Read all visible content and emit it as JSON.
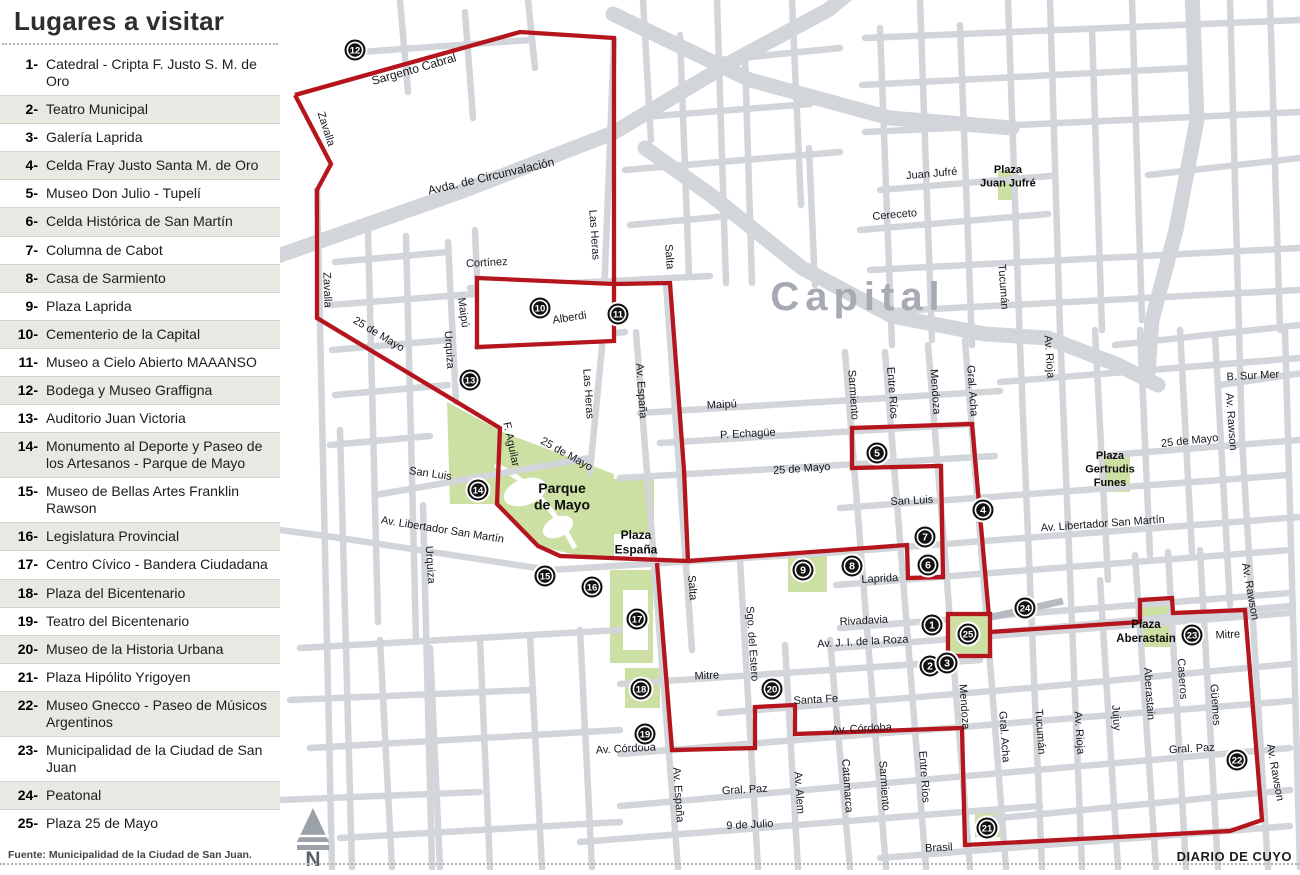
{
  "panel": {
    "title": "Lugares a visitar",
    "source": "Fuente: Municipalidad de la Ciudad de San Juan.",
    "items": [
      {
        "num": "1-",
        "label": "Catedral - Cripta F. Justo S. M. de Oro"
      },
      {
        "num": "2-",
        "label": "Teatro Municipal"
      },
      {
        "num": "3-",
        "label": "Galería Laprida"
      },
      {
        "num": "4-",
        "label": "Celda Fray Justo Santa M. de Oro"
      },
      {
        "num": "5-",
        "label": "Museo Don Julio - Tupelí"
      },
      {
        "num": "6-",
        "label": "Celda Histórica de San Martín"
      },
      {
        "num": "7-",
        "label": "Columna de Cabot"
      },
      {
        "num": "8-",
        "label": "Casa de Sarmiento"
      },
      {
        "num": "9-",
        "label": "Plaza Laprida"
      },
      {
        "num": "10-",
        "label": "Cementerio de la Capital"
      },
      {
        "num": "11-",
        "label": "Museo a Cielo Abierto MAAANSO"
      },
      {
        "num": "12-",
        "label": "Bodega y Museo Graffigna"
      },
      {
        "num": "13-",
        "label": "Auditorio Juan Victoria"
      },
      {
        "num": "14-",
        "label": "Monumento al Deporte y Paseo de los Artesanos - Parque de Mayo"
      },
      {
        "num": "15-",
        "label": "Museo de Bellas Artes Franklin Rawson"
      },
      {
        "num": "16-",
        "label": "Legislatura Provincial"
      },
      {
        "num": "17-",
        "label": "Centro Cívico - Bandera Ciudadana"
      },
      {
        "num": "18-",
        "label": "Plaza del Bicentenario"
      },
      {
        "num": "19-",
        "label": "Teatro del Bicentenario"
      },
      {
        "num": "20-",
        "label": "Museo de la Historia Urbana"
      },
      {
        "num": "21-",
        "label": "Plaza Hipólito Yrigoyen"
      },
      {
        "num": "22-",
        "label": "Museo Gnecco - Paseo de Músicos Argentinos"
      },
      {
        "num": "23-",
        "label": "Municipalidad de la Ciudad de San Juan"
      },
      {
        "num": "24-",
        "label": "Peatonal"
      },
      {
        "num": "25-",
        "label": "Plaza 25 de Mayo"
      }
    ]
  },
  "map": {
    "region_label": "Capital",
    "credit": "DIARIO DE CUYO",
    "north_label": "N",
    "colors": {
      "street": "#d2d5da",
      "route": "#b5151d",
      "green": "#cde0a4",
      "peatonal": "#b6bac1",
      "capital": "#a6abb3"
    },
    "street_labels": [
      {
        "t": "Sargento Cabral",
        "x": 135,
        "y": 73,
        "r": -16,
        "s": 12
      },
      {
        "t": "Zavalla",
        "x": 43,
        "y": 130,
        "r": 72
      },
      {
        "t": "Zavalla",
        "x": 44,
        "y": 290,
        "r": 88
      },
      {
        "t": "Avda. de Circunvalación",
        "x": 212,
        "y": 180,
        "r": -13,
        "s": 12
      },
      {
        "t": "Cortínez",
        "x": 207,
        "y": 266,
        "r": -3
      },
      {
        "t": "Maipú",
        "x": 180,
        "y": 313,
        "r": 82
      },
      {
        "t": "Alberdi",
        "x": 290,
        "y": 321,
        "r": -9
      },
      {
        "t": "Las Heras",
        "x": 311,
        "y": 235,
        "r": 86
      },
      {
        "t": "Las Heras",
        "x": 305,
        "y": 394,
        "r": 86
      },
      {
        "t": "Salta",
        "x": 386,
        "y": 257,
        "r": 86
      },
      {
        "t": "Salta",
        "x": 409,
        "y": 588,
        "r": 86
      },
      {
        "t": "Av. España",
        "x": 358,
        "y": 391,
        "r": 86
      },
      {
        "t": "Av. España",
        "x": 395,
        "y": 795,
        "r": 86
      },
      {
        "t": "25 de Mayo",
        "x": 97,
        "y": 337,
        "r": 31
      },
      {
        "t": "25 de Mayo",
        "x": 285,
        "y": 457,
        "r": 29
      },
      {
        "t": "25 de Mayo",
        "x": 522,
        "y": 472,
        "r": -4
      },
      {
        "t": "25 de Mayo",
        "x": 910,
        "y": 444,
        "r": -6
      },
      {
        "t": "P. Echagüe",
        "x": 468,
        "y": 437,
        "r": -3
      },
      {
        "t": "Maipú",
        "x": 442,
        "y": 408,
        "r": -3
      },
      {
        "t": "Urquiza",
        "x": 166,
        "y": 350,
        "r": 86
      },
      {
        "t": "Urquiza",
        "x": 147,
        "y": 565,
        "r": 86
      },
      {
        "t": "F. Aguilar",
        "x": 228,
        "y": 445,
        "r": 78
      },
      {
        "t": "San Luis",
        "x": 150,
        "y": 477,
        "r": 8
      },
      {
        "t": "San Luis",
        "x": 632,
        "y": 504,
        "r": -3
      },
      {
        "t": "Av. Libertador San Martín",
        "x": 162,
        "y": 533,
        "r": 9
      },
      {
        "t": "Av. Libertador San Martín",
        "x": 823,
        "y": 527,
        "r": -4
      },
      {
        "t": "Sarmiento",
        "x": 570,
        "y": 395,
        "r": 86
      },
      {
        "t": "Sarmiento",
        "x": 601,
        "y": 786,
        "r": 86
      },
      {
        "t": "Entre Ríos",
        "x": 609,
        "y": 393,
        "r": 86
      },
      {
        "t": "Entre Ríos",
        "x": 641,
        "y": 777,
        "r": 86
      },
      {
        "t": "Mendoza",
        "x": 652,
        "y": 392,
        "r": 86
      },
      {
        "t": "Mendoza",
        "x": 681,
        "y": 707,
        "r": 86
      },
      {
        "t": "Gral. Acha",
        "x": 689,
        "y": 391,
        "r": 86
      },
      {
        "t": "Gral. Acha",
        "x": 721,
        "y": 737,
        "r": 86
      },
      {
        "t": "Tucumán",
        "x": 720,
        "y": 287,
        "r": 86
      },
      {
        "t": "Tucumán",
        "x": 757,
        "y": 732,
        "r": 86
      },
      {
        "t": "Av. Rioja",
        "x": 766,
        "y": 357,
        "r": 86
      },
      {
        "t": "Av. Rioja",
        "x": 796,
        "y": 733,
        "r": 86
      },
      {
        "t": "Juan Jufré",
        "x": 652,
        "y": 177,
        "r": -5
      },
      {
        "t": "Cereceto",
        "x": 615,
        "y": 218,
        "r": -5
      },
      {
        "t": "B. Sur Mer",
        "x": 973,
        "y": 379,
        "r": -3
      },
      {
        "t": "Av. Rawson",
        "x": 948,
        "y": 422,
        "r": 86
      },
      {
        "t": "Av. Rawson",
        "x": 967,
        "y": 592,
        "r": 80
      },
      {
        "t": "Av. Rawson",
        "x": 992,
        "y": 773,
        "r": 80
      },
      {
        "t": "Laprida",
        "x": 600,
        "y": 582,
        "r": -3
      },
      {
        "t": "Rivadavia",
        "x": 584,
        "y": 624,
        "r": -3
      },
      {
        "t": "Av. J. I. de la Roza",
        "x": 583,
        "y": 645,
        "r": -3
      },
      {
        "t": "Mitre",
        "x": 427,
        "y": 679,
        "r": -3
      },
      {
        "t": "Mitre",
        "x": 948,
        "y": 638,
        "r": -3
      },
      {
        "t": "Santa Fe",
        "x": 536,
        "y": 703,
        "r": -3
      },
      {
        "t": "Av. Córdoba",
        "x": 346,
        "y": 752,
        "r": -3
      },
      {
        "t": "Av. Córdoba",
        "x": 582,
        "y": 732,
        "r": -3
      },
      {
        "t": "Sgo. del Estero",
        "x": 469,
        "y": 644,
        "r": 86
      },
      {
        "t": "Gral. Paz",
        "x": 465,
        "y": 793,
        "r": -3
      },
      {
        "t": "Gral. Paz",
        "x": 912,
        "y": 752,
        "r": -3
      },
      {
        "t": "9 de Julio",
        "x": 470,
        "y": 828,
        "r": -3
      },
      {
        "t": "Av. Alem",
        "x": 516,
        "y": 793,
        "r": 86
      },
      {
        "t": "Catamarca",
        "x": 564,
        "y": 786,
        "r": 86
      },
      {
        "t": "Brasil",
        "x": 659,
        "y": 851,
        "r": -3
      },
      {
        "t": "Jujuy",
        "x": 833,
        "y": 718,
        "r": 86
      },
      {
        "t": "Aberastain",
        "x": 866,
        "y": 694,
        "r": 86
      },
      {
        "t": "Caseros",
        "x": 899,
        "y": 679,
        "r": 86
      },
      {
        "t": "Güemes",
        "x": 932,
        "y": 705,
        "r": 86
      }
    ],
    "plaza_labels": [
      {
        "lines": [
          "Plaza",
          "Juan Jufré"
        ],
        "x": 728,
        "y": 173,
        "s": 11
      },
      {
        "lines": [
          "Plaza",
          "Gertrudis",
          "Funes"
        ],
        "x": 830,
        "y": 459,
        "s": 11
      },
      {
        "lines": [
          "Parque",
          "de Mayo"
        ],
        "x": 282,
        "y": 493,
        "s": 14
      },
      {
        "lines": [
          "Plaza",
          "España"
        ],
        "x": 356,
        "y": 539,
        "s": 12
      },
      {
        "lines": [
          "Plaza",
          "Aberastain"
        ],
        "x": 866,
        "y": 628,
        "s": 11.5
      }
    ],
    "markers": [
      {
        "n": "12",
        "x": 75,
        "y": 50
      },
      {
        "n": "10",
        "x": 260,
        "y": 308
      },
      {
        "n": "11",
        "x": 338,
        "y": 314
      },
      {
        "n": "13",
        "x": 190,
        "y": 380
      },
      {
        "n": "5",
        "x": 597,
        "y": 453
      },
      {
        "n": "14",
        "x": 198,
        "y": 490
      },
      {
        "n": "4",
        "x": 703,
        "y": 510
      },
      {
        "n": "7",
        "x": 645,
        "y": 537
      },
      {
        "n": "8",
        "x": 572,
        "y": 566
      },
      {
        "n": "6",
        "x": 648,
        "y": 565
      },
      {
        "n": "9",
        "x": 523,
        "y": 570
      },
      {
        "n": "15",
        "x": 265,
        "y": 576
      },
      {
        "n": "16",
        "x": 312,
        "y": 587
      },
      {
        "n": "17",
        "x": 357,
        "y": 619
      },
      {
        "n": "1",
        "x": 652,
        "y": 625
      },
      {
        "n": "25",
        "x": 688,
        "y": 634
      },
      {
        "n": "24",
        "x": 745,
        "y": 608
      },
      {
        "n": "23",
        "x": 912,
        "y": 635
      },
      {
        "n": "2",
        "x": 650,
        "y": 666
      },
      {
        "n": "3",
        "x": 667,
        "y": 663
      },
      {
        "n": "18",
        "x": 361,
        "y": 689
      },
      {
        "n": "20",
        "x": 492,
        "y": 689
      },
      {
        "n": "19",
        "x": 365,
        "y": 734
      },
      {
        "n": "22",
        "x": 957,
        "y": 760
      },
      {
        "n": "21",
        "x": 707,
        "y": 828
      }
    ]
  }
}
